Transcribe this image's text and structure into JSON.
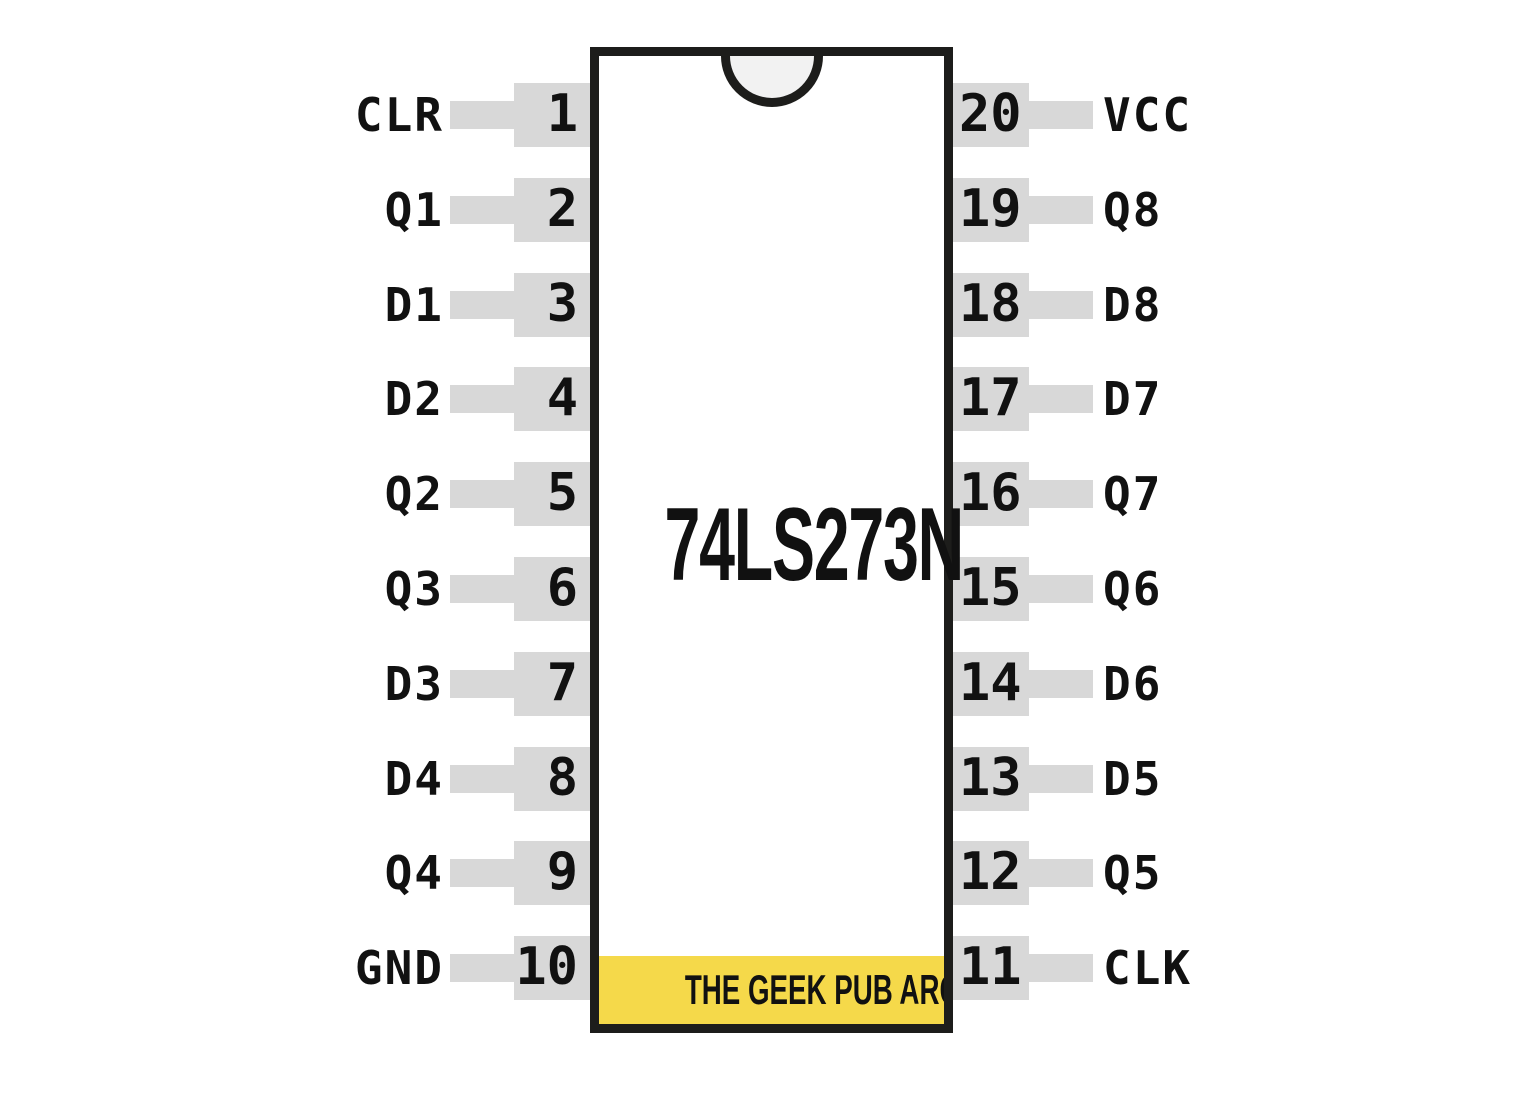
{
  "chip": {
    "title": "74LS273N",
    "banner_text": "THE GEEK PUB ARCADE"
  },
  "pins": {
    "left": [
      {
        "number": "1",
        "label": "CLR"
      },
      {
        "number": "2",
        "label": "Q1"
      },
      {
        "number": "3",
        "label": "D1"
      },
      {
        "number": "4",
        "label": "D2"
      },
      {
        "number": "5",
        "label": "Q2"
      },
      {
        "number": "6",
        "label": "Q3"
      },
      {
        "number": "7",
        "label": "D3"
      },
      {
        "number": "8",
        "label": "D4"
      },
      {
        "number": "9",
        "label": "Q4"
      },
      {
        "number": "10",
        "label": "GND"
      }
    ],
    "right": [
      {
        "number": "20",
        "label": "VCC"
      },
      {
        "number": "19",
        "label": "Q8"
      },
      {
        "number": "18",
        "label": "D8"
      },
      {
        "number": "17",
        "label": "D7"
      },
      {
        "number": "16",
        "label": "Q7"
      },
      {
        "number": "15",
        "label": "Q6"
      },
      {
        "number": "14",
        "label": "D6"
      },
      {
        "number": "13",
        "label": "D5"
      },
      {
        "number": "12",
        "label": "Q5"
      },
      {
        "number": "11",
        "label": "CLK"
      }
    ]
  },
  "colors": {
    "pin_gray": "#d8d8d8",
    "banner_yellow": "#f5d94a",
    "outline": "#1d1d1b",
    "notch_fill": "#f2f2f2",
    "text": "#111111"
  }
}
